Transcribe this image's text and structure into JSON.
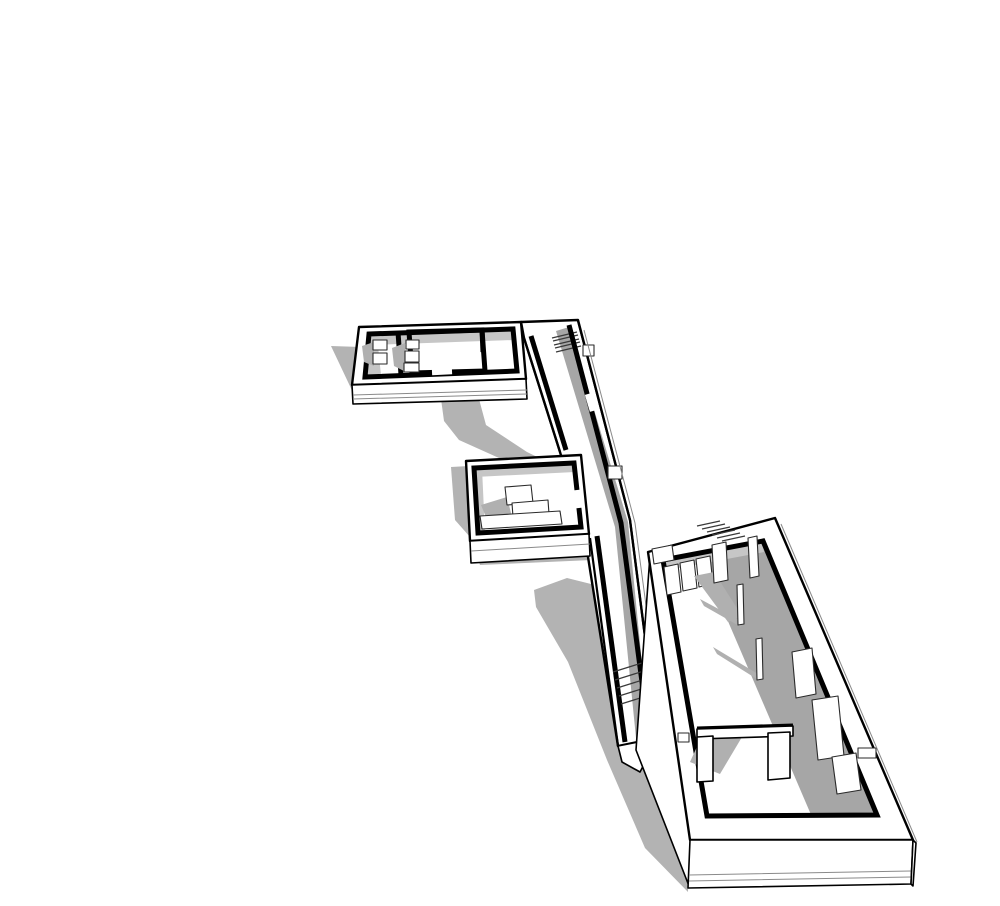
{
  "canvas": {
    "width": 1000,
    "height": 906,
    "background": "#ffffff"
  },
  "palette": {
    "surface": "#ffffff",
    "edge": "#000000",
    "ground_shadow": "#b3b3b3",
    "interior_shadow": "#a6a6a6",
    "soft_shadow": "#c6c6c6",
    "furniture_shadow": "#b0b0b0",
    "detail_line": "#8a8a8a"
  },
  "scene": {
    "type": "axonometric-architectural-model",
    "parts": [
      {
        "id": "cast-shadows",
        "label": "ground cast shadows"
      },
      {
        "id": "upper-wing",
        "label": "upper wing block with small rooms"
      },
      {
        "id": "upper-corridor",
        "label": "upper corridor with stairs"
      },
      {
        "id": "mid-room",
        "label": "middle room with furniture"
      },
      {
        "id": "lower-corridor",
        "label": "lower corridor with stairs"
      },
      {
        "id": "main-hall",
        "label": "main hall block"
      },
      {
        "id": "columns",
        "label": "interior columns"
      },
      {
        "id": "partitions",
        "label": "interior partition walls"
      }
    ]
  }
}
